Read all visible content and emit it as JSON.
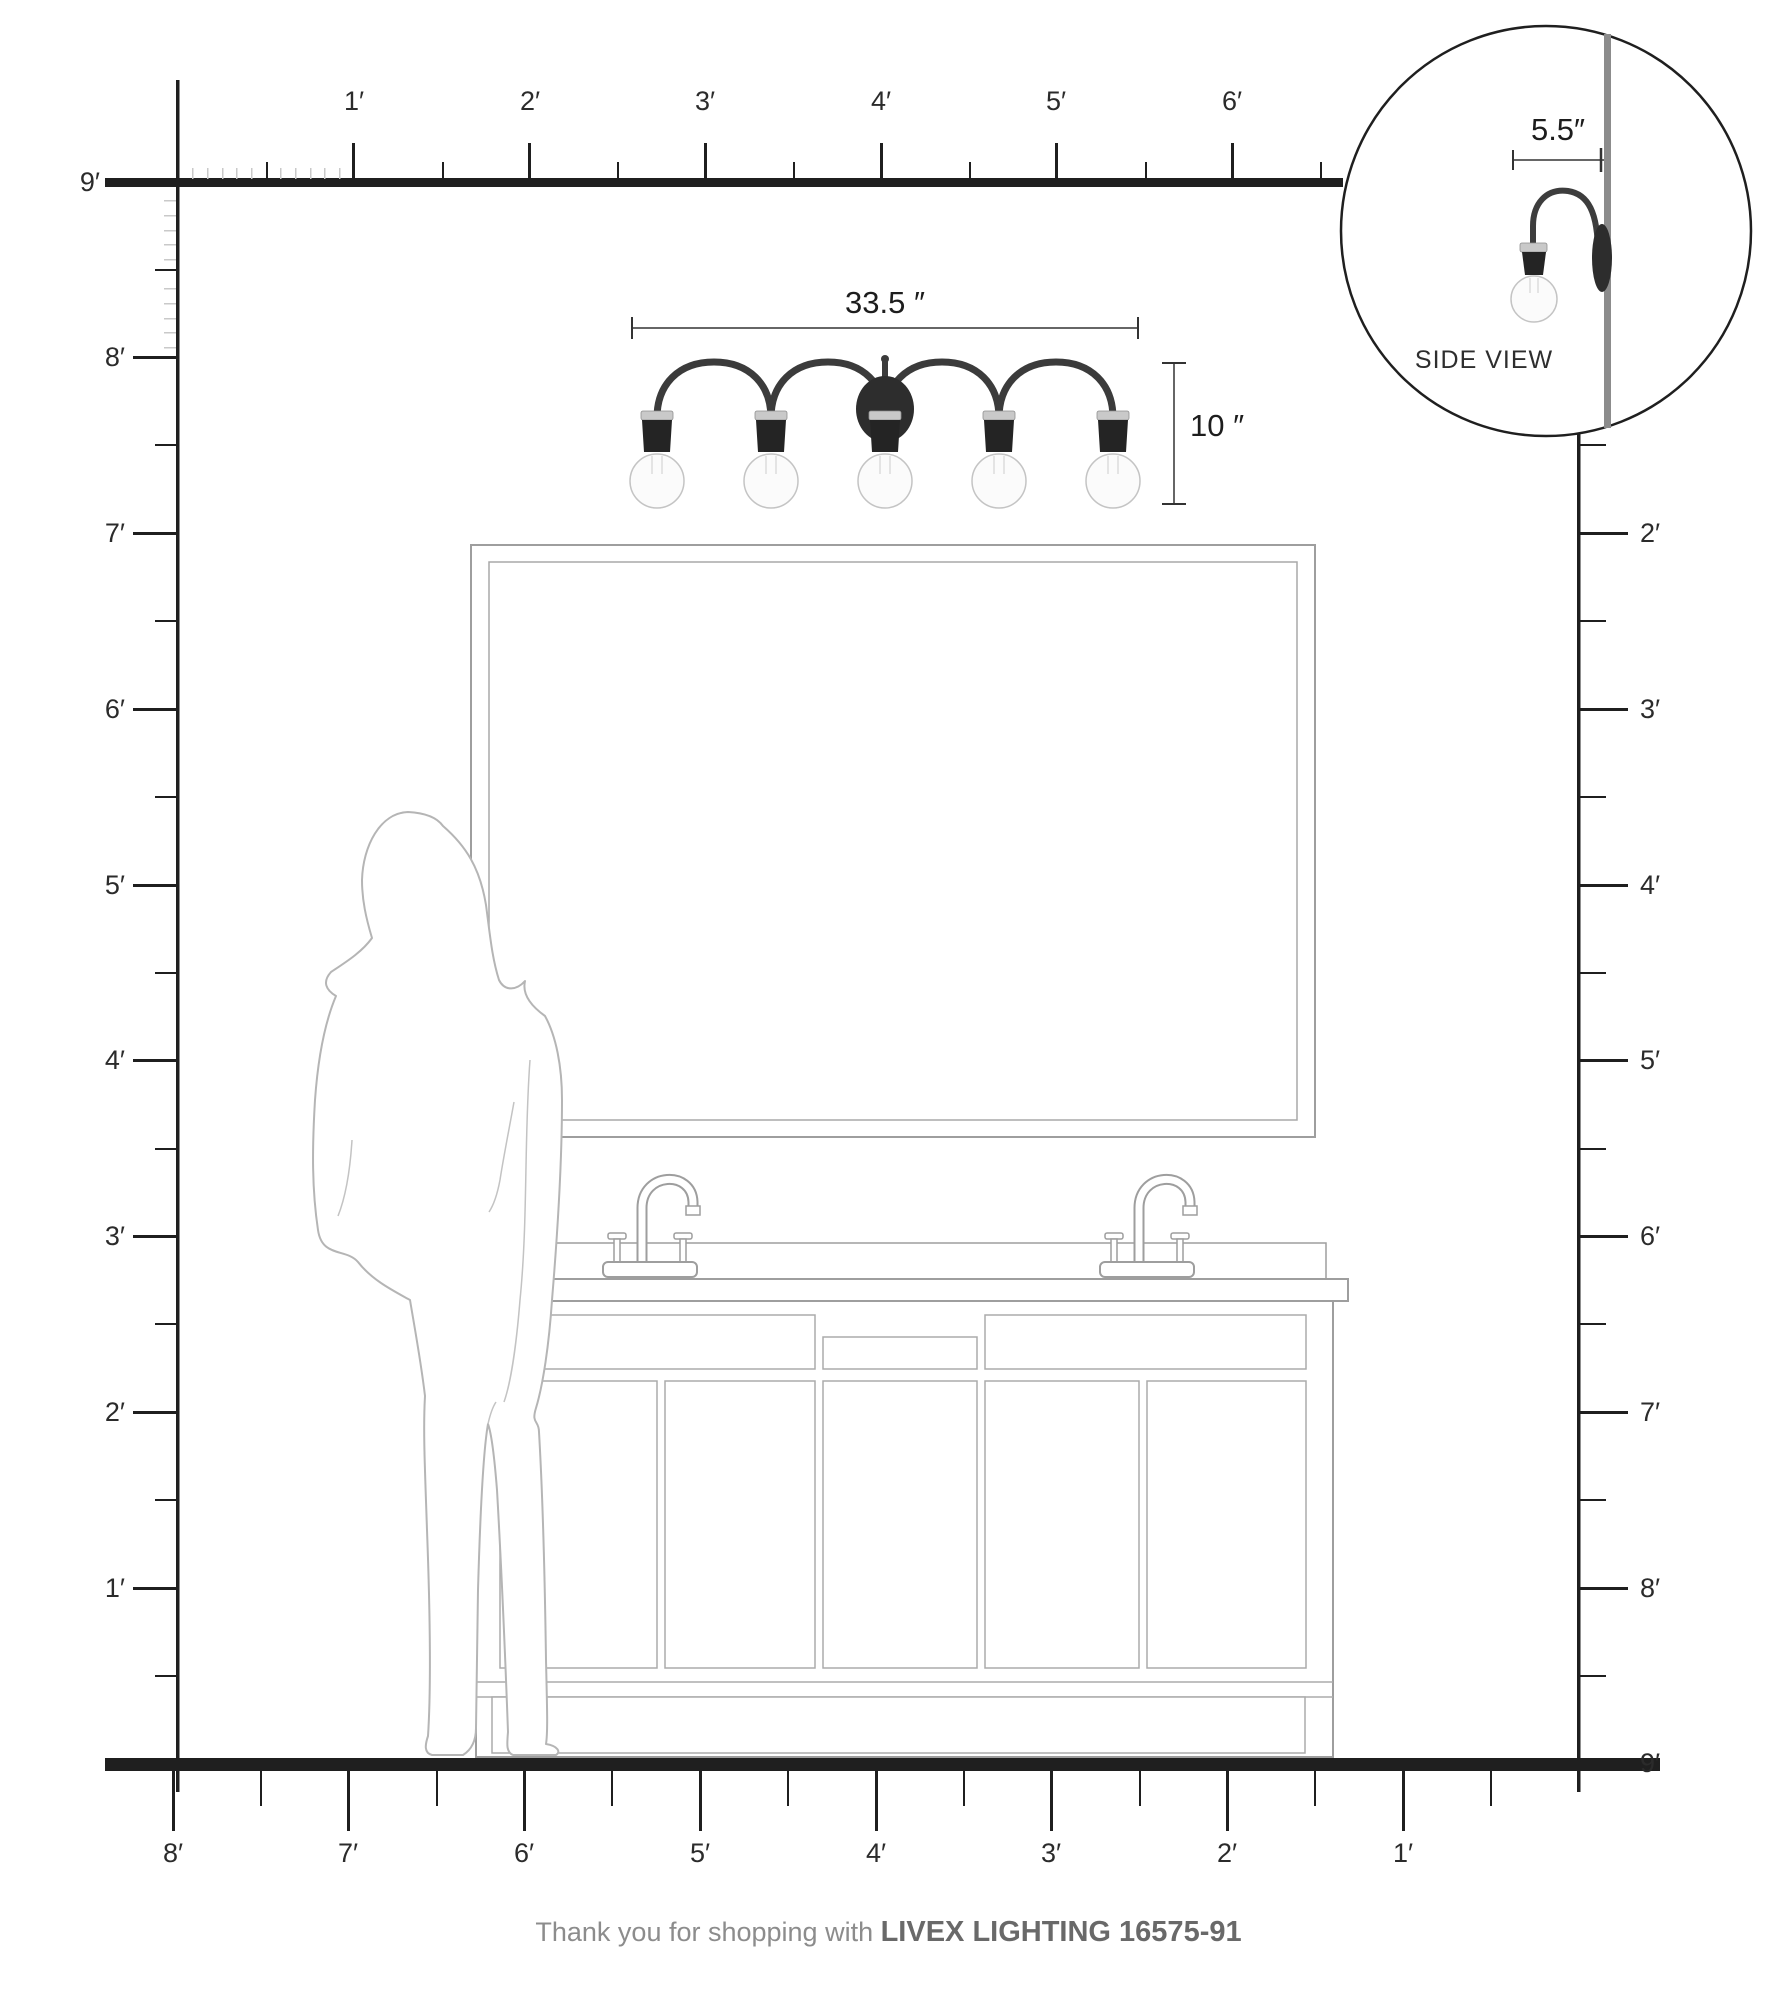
{
  "page": {
    "background": "#ffffff",
    "ink_color": "#1f1f1f",
    "drawing_line_color": "#9e9e9e",
    "silhouette_line_color": "#b5b5b5",
    "chrome_color": "#c9c9c9",
    "fixture_dark_color": "#2d2d2d"
  },
  "rulers": {
    "top": {
      "labels": [
        "1′",
        "2′",
        "3′",
        "4′",
        "5′",
        "6′"
      ]
    },
    "left": {
      "labels": [
        "9′",
        "8′",
        "7′",
        "6′",
        "5′",
        "4′",
        "3′",
        "2′",
        "1′"
      ]
    },
    "right": {
      "labels": [
        "2′",
        "3′",
        "4′",
        "5′",
        "6′",
        "7′",
        "8′",
        "9′"
      ]
    },
    "bottom": {
      "labels": [
        "8′",
        "7′",
        "6′",
        "5′",
        "4′",
        "3′",
        "2′",
        "1′"
      ]
    }
  },
  "fixture": {
    "width_label": "33.5 ″",
    "height_label": "10 ″",
    "bulb_count": 5
  },
  "side_view": {
    "depth_label": "5.5″",
    "caption": "SIDE VIEW"
  },
  "footer": {
    "prefix": "Thank you for shopping with ",
    "brand": "LIVEX LIGHTING 16575-91"
  }
}
